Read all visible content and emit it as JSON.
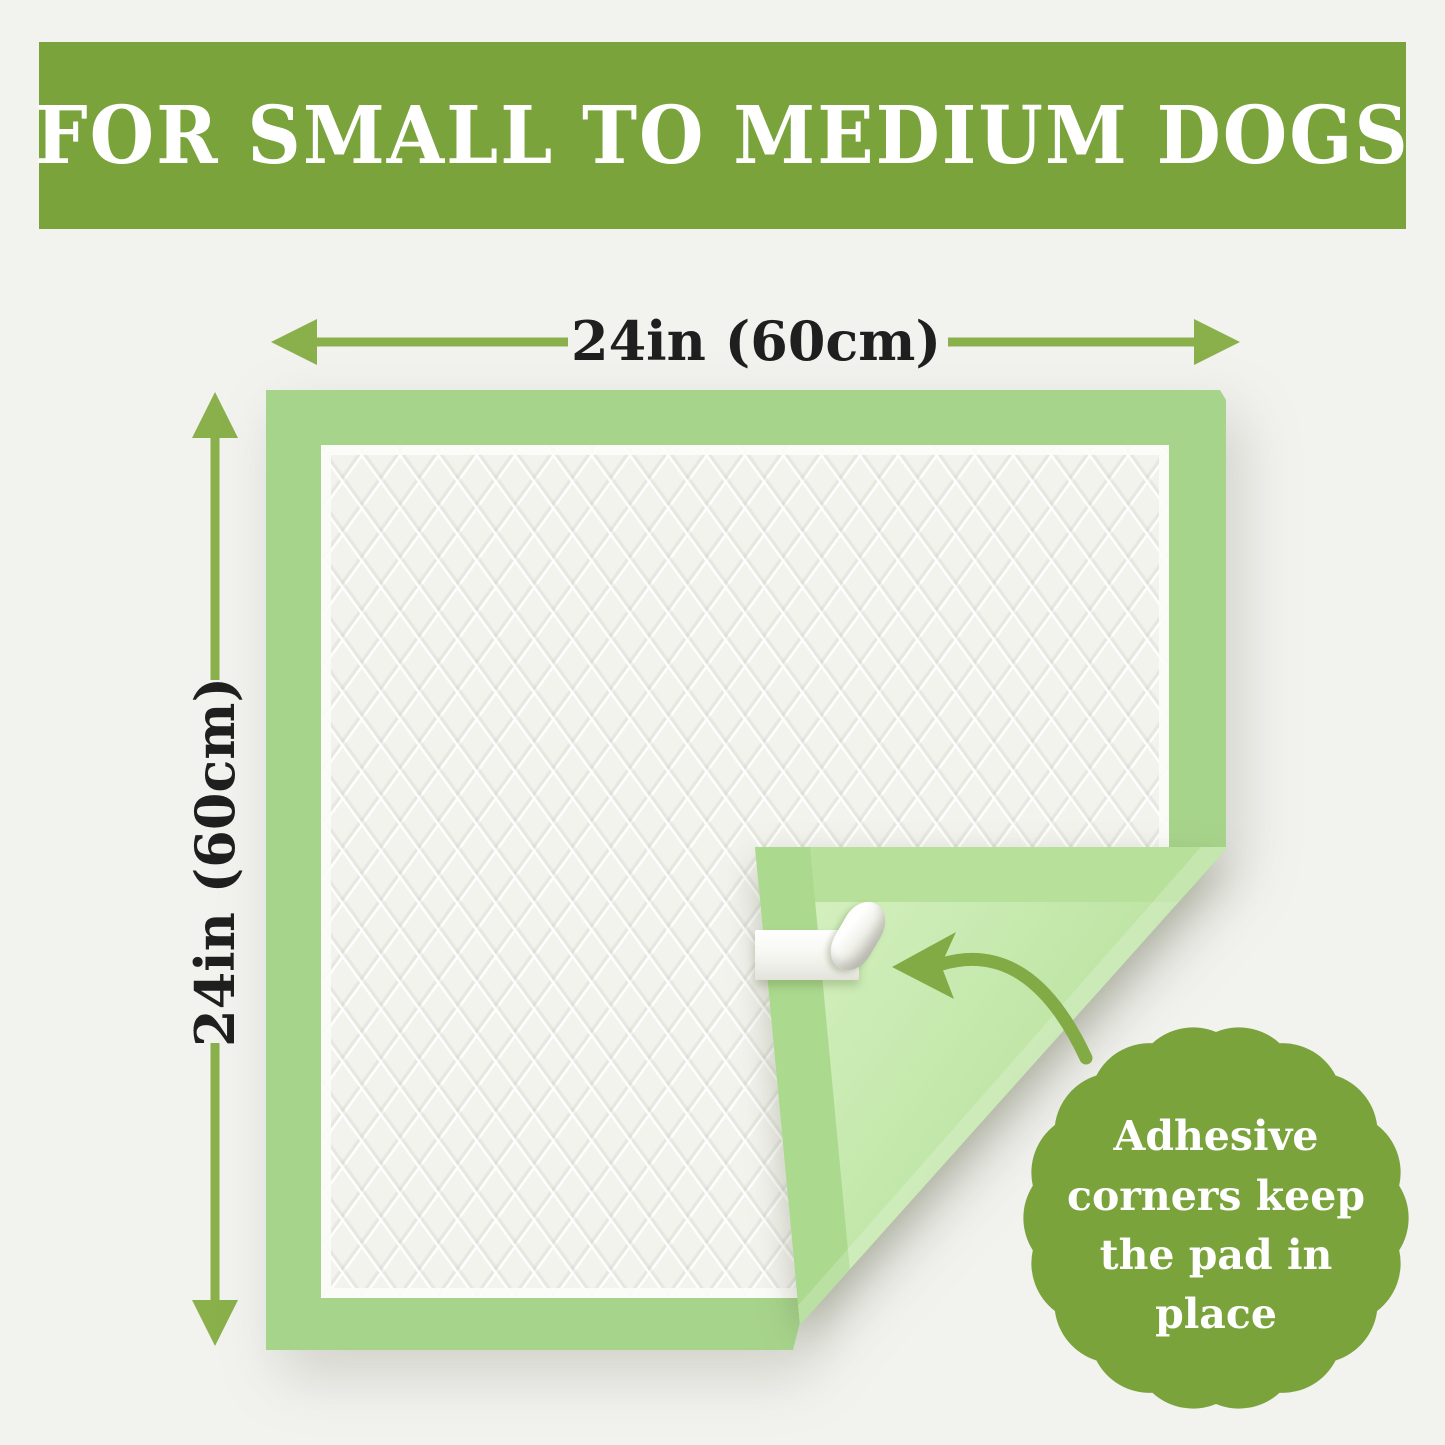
{
  "banner": {
    "text": "FOR SMALL TO MEDIUM DOGS"
  },
  "dimensions": {
    "width": {
      "label": "24in (60cm)"
    },
    "height": {
      "label": "24in (60cm)"
    }
  },
  "badge": {
    "lines": [
      "Adhesive",
      "corners keep",
      "the pad in",
      "place"
    ]
  },
  "icons": {
    "width_arrow": "double-headed-horizontal-arrow",
    "height_arrow": "double-headed-vertical-arrow",
    "fold_arrow": "curved-arrow-pointing-left",
    "adhesive_strip": "white-adhesive-tape-with-peeled-curl",
    "badge_shape": "scalloped-seal-circle"
  },
  "colors": {
    "banner_green": "#7aa33c",
    "badge_green": "#7aa33c",
    "dimension_arrow_green": "#8ab04c",
    "curved_arrow_green": "#82ab45",
    "pad_border_green": "#a7d48b",
    "pad_back_light_green": "#c6e9ae",
    "pad_surface_white": "#f3f3ee",
    "label_text": "#1f1f1f",
    "banner_text": "#ffffff",
    "badge_text": "#ffffff",
    "background": "#f2f2ef"
  }
}
